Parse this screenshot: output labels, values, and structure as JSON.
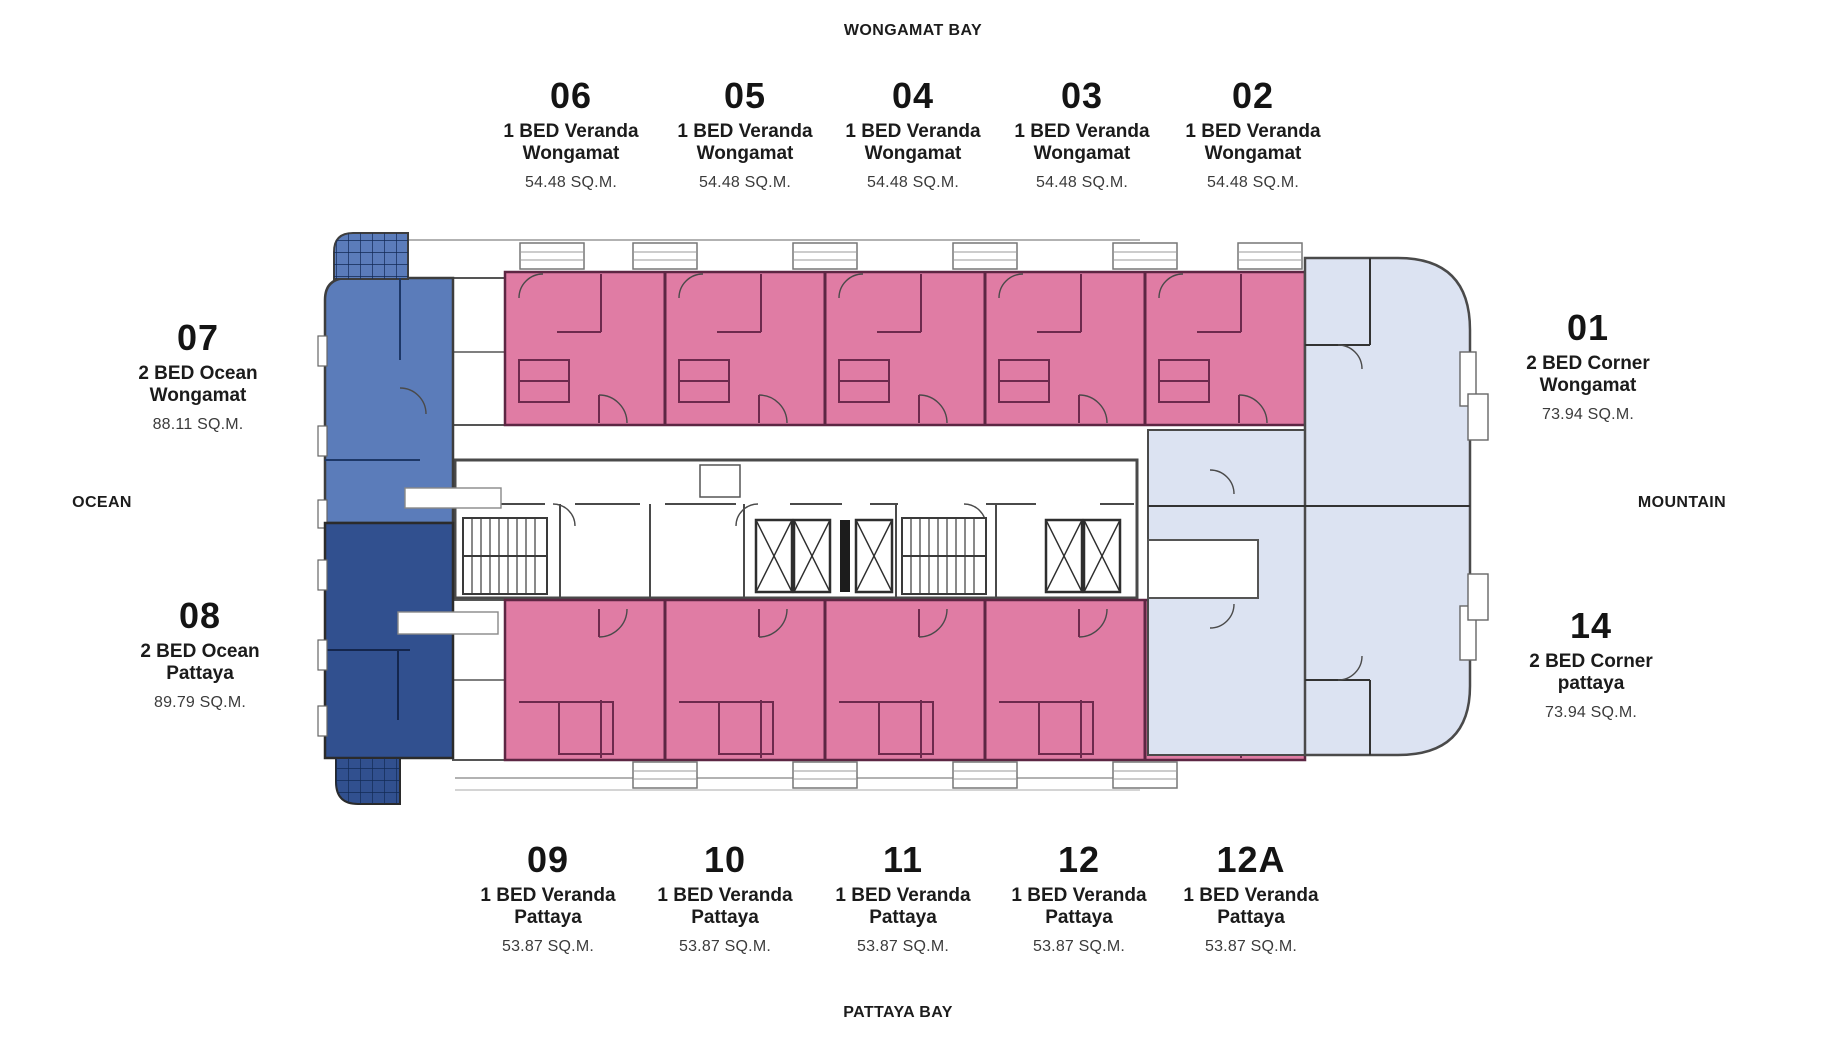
{
  "compass": {
    "top": "WONGAMAT BAY",
    "bottom": "PATTAYA BAY",
    "left": "OCEAN",
    "right": "MOUNTAIN"
  },
  "units": {
    "top": [
      {
        "number": "06",
        "line1": "1 BED Veranda",
        "line2": "Wongamat",
        "area": "54.48 SQ.M."
      },
      {
        "number": "05",
        "line1": "1 BED Veranda",
        "line2": "Wongamat",
        "area": "54.48 SQ.M."
      },
      {
        "number": "04",
        "line1": "1 BED Veranda",
        "line2": "Wongamat",
        "area": "54.48 SQ.M."
      },
      {
        "number": "03",
        "line1": "1 BED Veranda",
        "line2": "Wongamat",
        "area": "54.48 SQ.M."
      },
      {
        "number": "02",
        "line1": "1 BED Veranda",
        "line2": "Wongamat",
        "area": "54.48 SQ.M."
      }
    ],
    "bottom": [
      {
        "number": "09",
        "line1": "1 BED Veranda",
        "line2": "Pattaya",
        "area": "53.87 SQ.M."
      },
      {
        "number": "10",
        "line1": "1 BED Veranda",
        "line2": "Pattaya",
        "area": "53.87 SQ.M."
      },
      {
        "number": "11",
        "line1": "1 BED Veranda",
        "line2": "Pattaya",
        "area": "53.87 SQ.M."
      },
      {
        "number": "12",
        "line1": "1 BED Veranda",
        "line2": "Pattaya",
        "area": "53.87 SQ.M."
      },
      {
        "number": "12A",
        "line1": "1 BED Veranda",
        "line2": "Pattaya",
        "area": "53.87 SQ.M."
      }
    ],
    "left": [
      {
        "number": "07",
        "line1": "2 BED Ocean",
        "line2": "Wongamat",
        "area": "88.11 SQ.M."
      },
      {
        "number": "08",
        "line1": "2 BED Ocean",
        "line2": "Pattaya",
        "area": "89.79 SQ.M."
      }
    ],
    "right": [
      {
        "number": "01",
        "line1": "2 BED Corner",
        "line2": "Wongamat",
        "area": "73.94 SQ.M."
      },
      {
        "number": "14",
        "line1": "2 BED Corner",
        "line2": "pattaya",
        "area": "73.94 SQ.M."
      }
    ]
  },
  "colors": {
    "pink": "#e07ca4",
    "pink_wall": "#6e2a4d",
    "blue_medium": "#5b7cba",
    "blue_dark": "#31508f",
    "blue_light": "#dce3f2",
    "wall": "#4a4a4a",
    "text": "#171717",
    "text_area": "#3b3b3b"
  }
}
